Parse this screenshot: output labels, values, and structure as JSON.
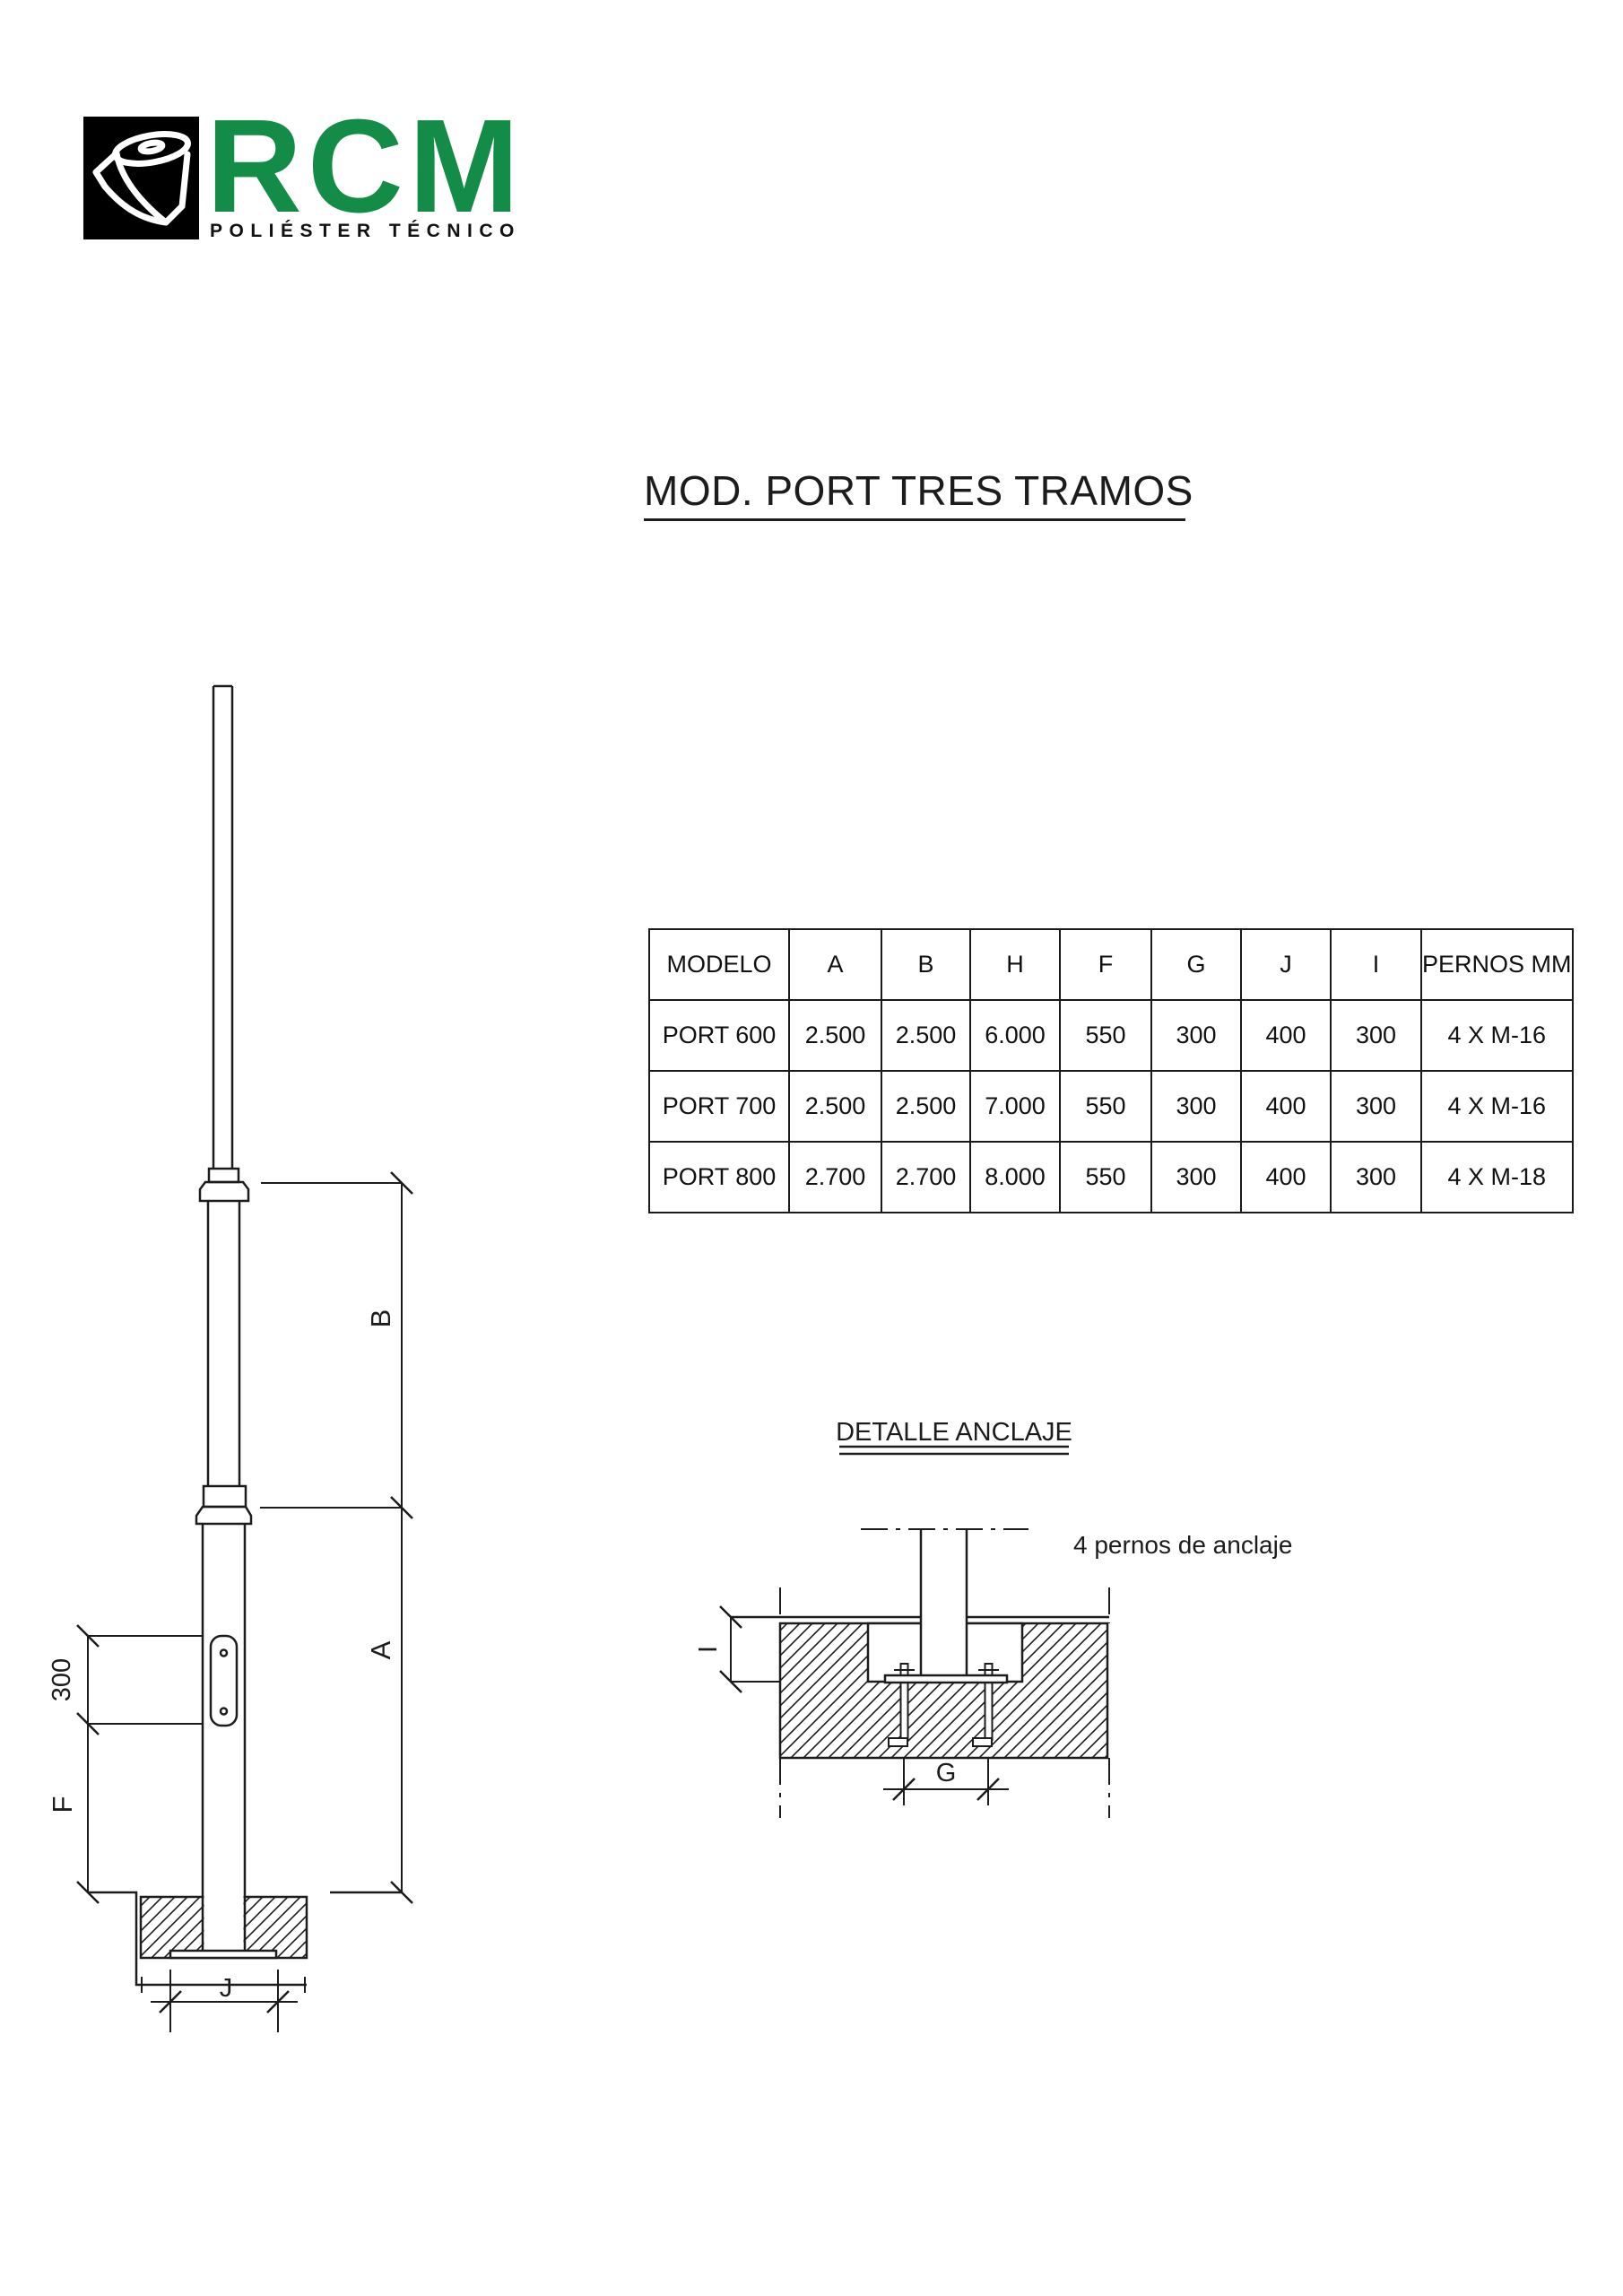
{
  "logo": {
    "brand": "RCM",
    "subtitle": "POLIÉSTER TÉCNICO",
    "brand_color": "#128c46",
    "icon": "material-roll-icon"
  },
  "title": "MOD. PORT TRES TRAMOS",
  "table": {
    "columns": [
      "MODELO",
      "A",
      "B",
      "H",
      "F",
      "G",
      "J",
      "I",
      "PERNOS MM"
    ],
    "rows": [
      [
        "PORT 600",
        "2.500",
        "2.500",
        "6.000",
        "550",
        "300",
        "400",
        "300",
        "4 X M-16"
      ],
      [
        "PORT 700",
        "2.500",
        "2.500",
        "7.000",
        "550",
        "300",
        "400",
        "300",
        "4 X M-16"
      ],
      [
        "PORT 800",
        "2.700",
        "2.700",
        "8.000",
        "550",
        "300",
        "400",
        "300",
        "4 X M-18"
      ]
    ]
  },
  "pole_drawing": {
    "dim_b": "B",
    "dim_a": "A",
    "dim_top_section": "300",
    "dim_f": "F",
    "dim_j": "J"
  },
  "anchor_detail": {
    "title": "DETALLE ANCLAJE",
    "note": "4 pernos de anclaje",
    "dim_i": "I",
    "dim_g": "G"
  },
  "colors": {
    "line": "#1c1c1c",
    "accent_green": "#128c46"
  }
}
